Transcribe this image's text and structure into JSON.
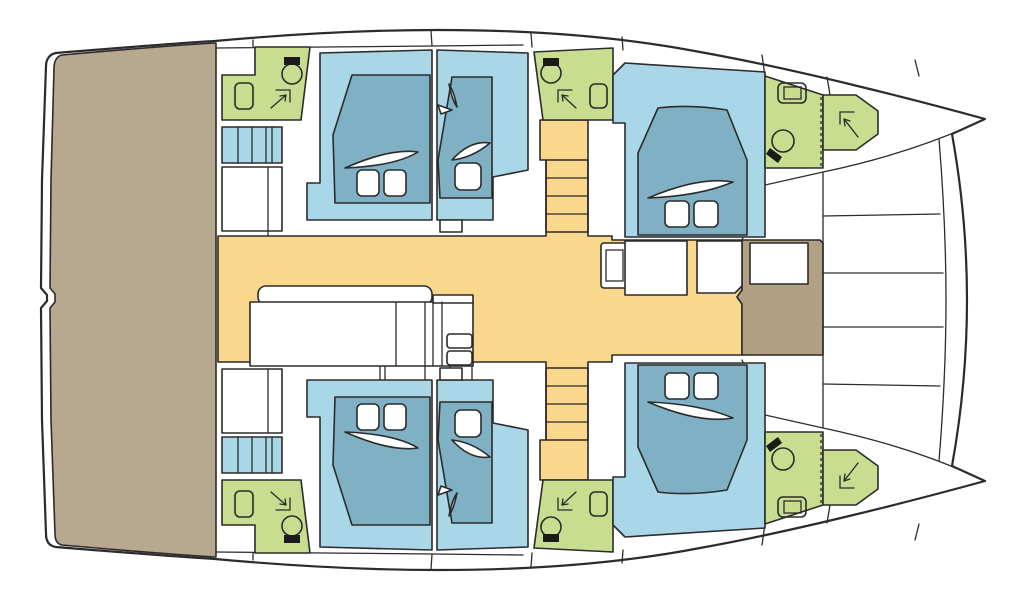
{
  "plan": {
    "subject": "catamaran-deck-plan",
    "view": "top-down",
    "orientation": "bow-right"
  },
  "colors": {
    "outline": "#2b2b2b",
    "hull_white": "#ffffff",
    "aft_deck_tan": "#b9a890",
    "foredeck_tan": "#b1a084",
    "saloon_yellow": "#f9d78c",
    "cabin_blue": "#a9d7e7",
    "bed_blue": "#80b0c4",
    "bathroom_green": "#c8dd90",
    "fixture_black": "#1a1a1a",
    "linen_white": "#ffffff"
  },
  "rooms": {
    "aft_deck": "aft cockpit deck",
    "saloon": "central saloon",
    "foredeck": "foredeck locker",
    "trampoline": "bow trampoline",
    "port_hull": [
      "aft bathroom",
      "aft cabin",
      "mid cabin",
      "mid bathroom",
      "forward cabin",
      "bow bathroom"
    ],
    "starboard_hull": [
      "aft bathroom",
      "aft cabin",
      "mid cabin",
      "mid bathroom",
      "forward cabin",
      "bow bathroom"
    ]
  },
  "icons": {
    "toilet": "toilet-icon",
    "sink": "sink-icon",
    "shower": "shower-arrow-icon",
    "bed": "double-or-single-berth",
    "pillow": "pillow",
    "stairs": "companionway-stairs",
    "steps": "hull-steps",
    "crossbeam": "forward-crossbeam"
  }
}
